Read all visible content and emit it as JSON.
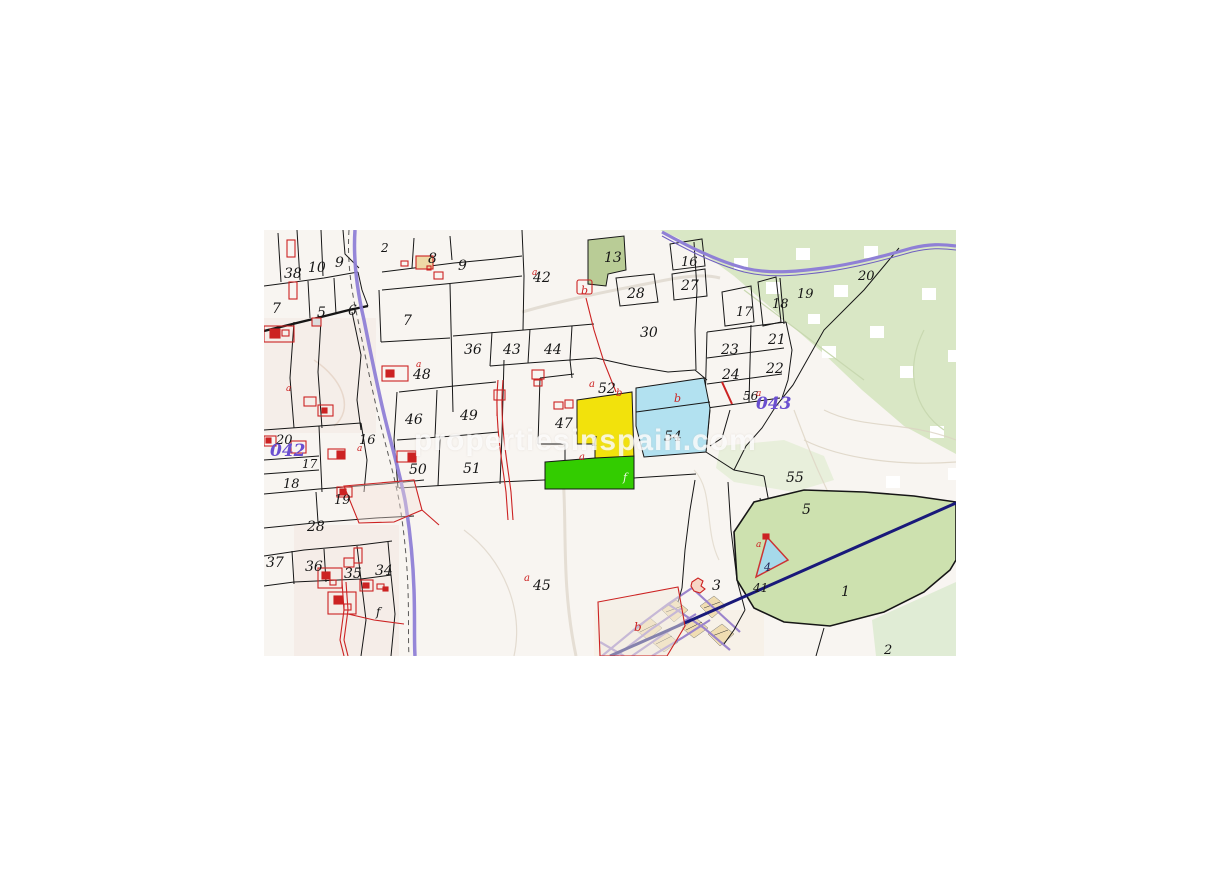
{
  "map": {
    "watermark": "propertiesinspain.com",
    "colors": {
      "background": "#f8f5f1",
      "parcel_line": "#161616",
      "building_red": "#cc2222",
      "road_purple": "#8f80d6",
      "road_navy": "#19197a",
      "sector_purple": "#6a4fd0",
      "highlight_yellow": "#f2e20c",
      "highlight_green": "#33cc00",
      "highlight_cyan": "#b2e1f0",
      "terrain_green": "#d9e7c5",
      "urban_block_tan": "#f0ddb2"
    },
    "highlights": {
      "yellow_parcel": "1",
      "cyan_parcel": "54",
      "green_strip": "f",
      "pond_parcel": "4"
    },
    "sector_codes": [
      "042",
      "043"
    ],
    "labels": [
      {
        "text": "38",
        "x": 20,
        "y": 48,
        "color": "#161616",
        "size": 14
      },
      {
        "text": "10",
        "x": 44,
        "y": 42,
        "color": "#161616",
        "size": 14
      },
      {
        "text": "9",
        "x": 71,
        "y": 37,
        "color": "#161616",
        "size": 14
      },
      {
        "text": "2",
        "x": 117,
        "y": 22,
        "color": "#161616",
        "size": 12
      },
      {
        "text": "7",
        "x": 8,
        "y": 83,
        "color": "#161616",
        "size": 14
      },
      {
        "text": "5",
        "x": 53,
        "y": 87,
        "color": "#161616",
        "size": 14
      },
      {
        "text": "6",
        "x": 84,
        "y": 85,
        "color": "#161616",
        "size": 14
      },
      {
        "text": "8",
        "x": 164,
        "y": 33,
        "color": "#161616",
        "size": 14
      },
      {
        "text": "9",
        "x": 194,
        "y": 40,
        "color": "#161616",
        "size": 14
      },
      {
        "text": "7",
        "x": 139,
        "y": 95,
        "color": "#161616",
        "size": 14
      },
      {
        "text": "36",
        "x": 200,
        "y": 124,
        "color": "#161616",
        "size": 14
      },
      {
        "text": "43",
        "x": 239,
        "y": 124,
        "color": "#161616",
        "size": 14
      },
      {
        "text": "44",
        "x": 280,
        "y": 124,
        "color": "#161616",
        "size": 14
      },
      {
        "text": "42",
        "x": 269,
        "y": 52,
        "color": "#161616",
        "size": 14
      },
      {
        "text": "13",
        "x": 340,
        "y": 32,
        "color": "#161616",
        "size": 14
      },
      {
        "text": "28",
        "x": 363,
        "y": 68,
        "color": "#161616",
        "size": 14
      },
      {
        "text": "16",
        "x": 417,
        "y": 36,
        "color": "#161616",
        "size": 13
      },
      {
        "text": "27",
        "x": 417,
        "y": 60,
        "color": "#161616",
        "size": 14
      },
      {
        "text": "30",
        "x": 376,
        "y": 107,
        "color": "#161616",
        "size": 14
      },
      {
        "text": "17",
        "x": 472,
        "y": 86,
        "color": "#161616",
        "size": 13
      },
      {
        "text": "18",
        "x": 508,
        "y": 78,
        "color": "#161616",
        "size": 13
      },
      {
        "text": "19",
        "x": 533,
        "y": 68,
        "color": "#161616",
        "size": 13
      },
      {
        "text": "20",
        "x": 594,
        "y": 50,
        "color": "#161616",
        "size": 13
      },
      {
        "text": "21",
        "x": 504,
        "y": 114,
        "color": "#161616",
        "size": 14
      },
      {
        "text": "23",
        "x": 457,
        "y": 124,
        "color": "#161616",
        "size": 14
      },
      {
        "text": "22",
        "x": 502,
        "y": 143,
        "color": "#161616",
        "size": 14
      },
      {
        "text": "24",
        "x": 458,
        "y": 149,
        "color": "#161616",
        "size": 14
      },
      {
        "text": "56",
        "x": 479,
        "y": 170,
        "color": "#161616",
        "size": 12
      },
      {
        "text": "48",
        "x": 149,
        "y": 149,
        "color": "#161616",
        "size": 14
      },
      {
        "text": "46",
        "x": 141,
        "y": 194,
        "color": "#161616",
        "size": 14
      },
      {
        "text": "49",
        "x": 196,
        "y": 190,
        "color": "#161616",
        "size": 14
      },
      {
        "text": "47",
        "x": 291,
        "y": 198,
        "color": "#161616",
        "size": 14
      },
      {
        "text": "52",
        "x": 334,
        "y": 163,
        "color": "#161616",
        "size": 14
      },
      {
        "text": "20",
        "x": 12,
        "y": 214,
        "color": "#161616",
        "size": 13
      },
      {
        "text": "16",
        "x": 95,
        "y": 214,
        "color": "#161616",
        "size": 13
      },
      {
        "text": "17",
        "x": 38,
        "y": 238,
        "color": "#161616",
        "size": 12
      },
      {
        "text": "18",
        "x": 19,
        "y": 258,
        "color": "#161616",
        "size": 13
      },
      {
        "text": "19",
        "x": 70,
        "y": 274,
        "color": "#161616",
        "size": 13
      },
      {
        "text": "50",
        "x": 145,
        "y": 244,
        "color": "#161616",
        "size": 14
      },
      {
        "text": "51",
        "x": 199,
        "y": 243,
        "color": "#161616",
        "size": 14
      },
      {
        "text": "1",
        "x": 327,
        "y": 216,
        "color": "#161616",
        "size": 13
      },
      {
        "text": "54",
        "x": 400,
        "y": 211,
        "color": "#161616",
        "size": 14
      },
      {
        "text": "55",
        "x": 522,
        "y": 252,
        "color": "#161616",
        "size": 14
      },
      {
        "text": "5",
        "x": 538,
        "y": 284,
        "color": "#161616",
        "size": 14
      },
      {
        "text": "28",
        "x": 43,
        "y": 301,
        "color": "#161616",
        "size": 14
      },
      {
        "text": "37",
        "x": 2,
        "y": 337,
        "color": "#161616",
        "size": 14
      },
      {
        "text": "36",
        "x": 41,
        "y": 341,
        "color": "#161616",
        "size": 14
      },
      {
        "text": "35",
        "x": 80,
        "y": 348,
        "color": "#161616",
        "size": 14
      },
      {
        "text": "34",
        "x": 111,
        "y": 345,
        "color": "#161616",
        "size": 14
      },
      {
        "text": "f",
        "x": 112,
        "y": 386,
        "color": "#161616",
        "size": 12
      },
      {
        "text": "45",
        "x": 269,
        "y": 360,
        "color": "#161616",
        "size": 14
      },
      {
        "text": "3",
        "x": 448,
        "y": 360,
        "color": "#161616",
        "size": 14
      },
      {
        "text": "41",
        "x": 489,
        "y": 362,
        "color": "#161616",
        "size": 12
      },
      {
        "text": "1",
        "x": 577,
        "y": 366,
        "color": "#161616",
        "size": 14
      },
      {
        "text": "2",
        "x": 620,
        "y": 424,
        "color": "#161616",
        "size": 13
      },
      {
        "text": "4",
        "x": 500,
        "y": 341,
        "color": "#232355",
        "size": 11
      },
      {
        "text": "f",
        "x": 359,
        "y": 251,
        "color": "#eaf8e0",
        "size": 11
      },
      {
        "text": "a",
        "x": 325,
        "y": 157,
        "color": "#cc2222",
        "size": 10
      },
      {
        "text": "b",
        "x": 352,
        "y": 166,
        "color": "#cc2222",
        "size": 10
      },
      {
        "text": "b",
        "x": 410,
        "y": 172,
        "color": "#cc2222",
        "size": 11
      },
      {
        "text": "a",
        "x": 315,
        "y": 230,
        "color": "#cc2222",
        "size": 10
      },
      {
        "text": "a",
        "x": 260,
        "y": 351,
        "color": "#cc2222",
        "size": 10
      },
      {
        "text": "a",
        "x": 152,
        "y": 137,
        "color": "#cc2222",
        "size": 9
      },
      {
        "text": "a",
        "x": 268,
        "y": 45,
        "color": "#cc2222",
        "size": 9
      },
      {
        "text": "a",
        "x": 22,
        "y": 161,
        "color": "#cc2222",
        "size": 9
      },
      {
        "text": "a",
        "x": 93,
        "y": 221,
        "color": "#cc2222",
        "size": 9
      },
      {
        "text": "a",
        "x": 492,
        "y": 166,
        "color": "#cc2222",
        "size": 9
      },
      {
        "text": "b",
        "x": 370,
        "y": 401,
        "color": "#cc2222",
        "size": 12
      },
      {
        "text": "a",
        "x": 492,
        "y": 317,
        "color": "#cc2222",
        "size": 9
      },
      {
        "text": "b",
        "x": 317,
        "y": 64,
        "color": "#cc2222",
        "size": 11
      },
      {
        "text": "042",
        "x": 6,
        "y": 226,
        "color": "#6a4fd0",
        "size": 17,
        "bold": true
      },
      {
        "text": "043",
        "x": 492,
        "y": 179,
        "color": "#6a4fd0",
        "size": 17,
        "bold": true
      }
    ]
  }
}
